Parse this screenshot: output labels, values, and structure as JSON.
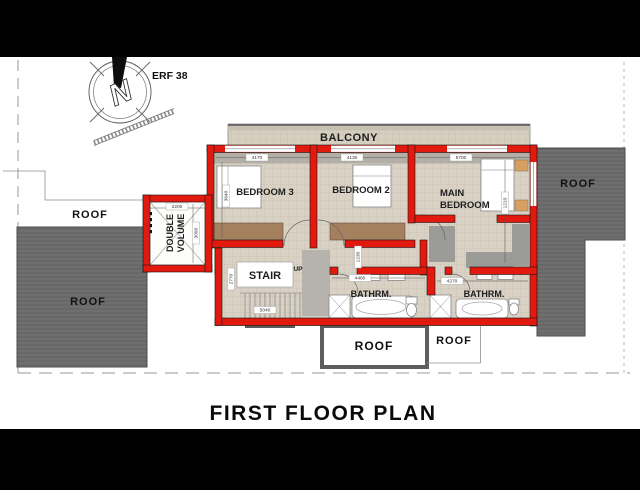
{
  "title": "FIRST FLOOR PLAN",
  "site": {
    "erf": "ERF 38",
    "north_letter": "N"
  },
  "labels": {
    "balcony": "BALCONY",
    "bedroom3": "BEDROOM 3",
    "bedroom2": "BEDROOM 2",
    "main_bedroom_line1": "MAIN",
    "main_bedroom_line2": "BEDROOM",
    "double_volume_line1": "DOUBLE",
    "double_volume_line2": "VOLUME",
    "stair": "STAIR",
    "up": "UP",
    "bathroom_left": "BATHRM.",
    "bathroom_right": "BATHRM.",
    "roof_left_top": "ROOF",
    "roof_left_bottom": "ROOF",
    "roof_right": "ROOF",
    "roof_bottom_box": "ROOF",
    "roof_bottom_right": "ROOF"
  },
  "dimensions": {
    "bedroom3_width": "4170",
    "bedroom2_width": "4130",
    "main_bedroom_width": "5700",
    "bedroom3_depth": "3640",
    "main_bedroom_depth": "1210",
    "double_volume_width": "2200",
    "double_volume_depth": "3090",
    "passage_width": "1230",
    "stair_width": "5040",
    "stair_depth": "2770",
    "bathroom_left_width": "4460",
    "bathroom_right_width": "4270"
  },
  "colors": {
    "wall_red": "#e2190f",
    "floor_beige": "#d9d2c4",
    "balcony_floor": "#d6cfc0",
    "roof_dark_gray": "#6f6f6f",
    "cupboard_brown": "#a5805f",
    "shadow_gray": "#b3afa6",
    "side_table_tan": "#d79f62",
    "letterbox_black": "#000000"
  }
}
